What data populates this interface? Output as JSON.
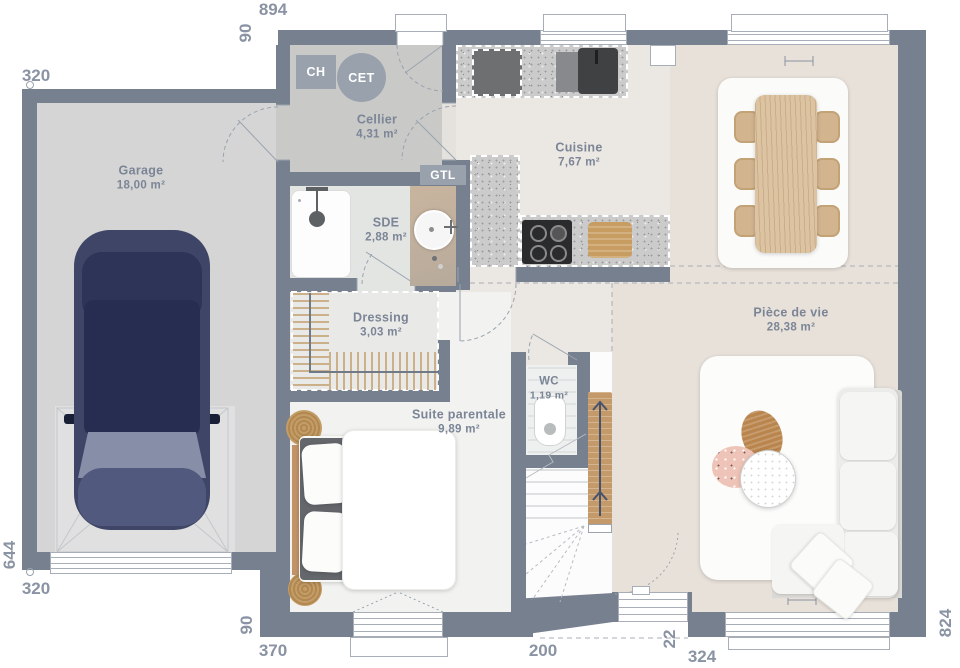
{
  "rooms": {
    "garage": {
      "name": "Garage",
      "area": "18,00 m²"
    },
    "cellier": {
      "name": "Cellier",
      "area": "4,31 m²"
    },
    "cuisine": {
      "name": "Cuisine",
      "area": "7,67 m²"
    },
    "piece_de_vie": {
      "name": "Pièce de vie",
      "area": "28,38 m²"
    },
    "sde": {
      "name": "SDE",
      "area": "2,88 m²"
    },
    "dressing": {
      "name": "Dressing",
      "area": "3,03 m²"
    },
    "suite": {
      "name": "Suite parentale",
      "area": "9,89 m²"
    },
    "wc": {
      "name": "WC",
      "area": "1,19 m²"
    }
  },
  "equipment": {
    "ch": "CH",
    "cet": "CET",
    "gtl": "GTL"
  },
  "dims": {
    "top_width": "894",
    "top_left_offset": "90",
    "garage_width_top": "320",
    "left_height": "644",
    "garage_width_bottom": "320",
    "bottom_left_offset": "90",
    "bedroom_width": "370",
    "stair_width": "200",
    "recess_depth": "22",
    "living_width": "324",
    "right_height": "824"
  },
  "colors": {
    "wall": "#76808f",
    "dim_text": "#8a93a3",
    "label_text": "#7b8596",
    "wood": "#c59a6b",
    "floor_living": "#e8e1da",
    "floor_kitchen": "#ebe7e2",
    "floor_garage": "#d4d5d4",
    "floor_bedroom": "#f2f2f1"
  }
}
